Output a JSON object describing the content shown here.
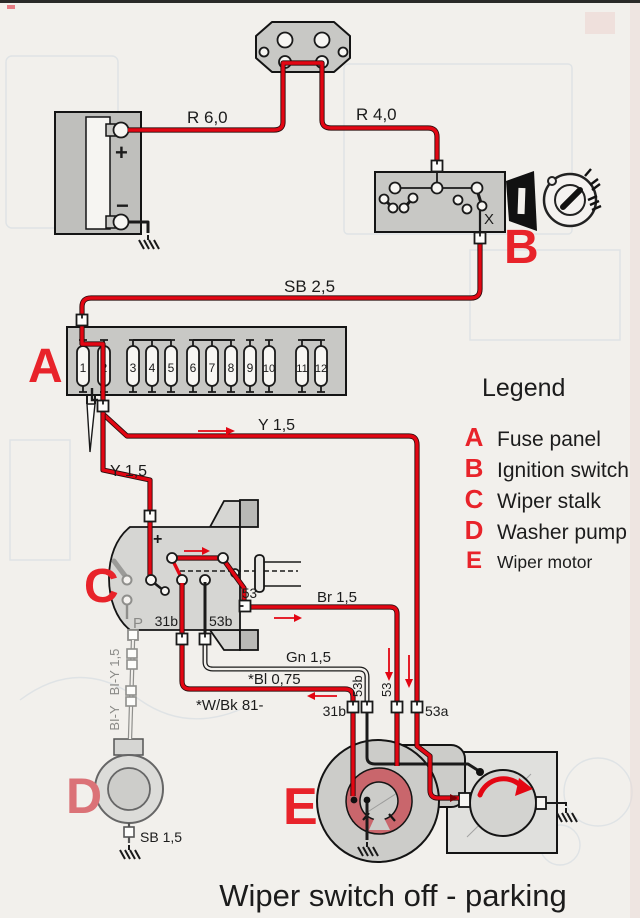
{
  "title": "Wiper switch off - parking",
  "legend": {
    "title": "Legend",
    "items": [
      {
        "key": "A",
        "label": "Fuse panel"
      },
      {
        "key": "B",
        "label": "Ignition switch"
      },
      {
        "key": "C",
        "label": "Wiper stalk"
      },
      {
        "key": "D",
        "label": "Washer pump"
      },
      {
        "key": "E",
        "label": "Wiper motor"
      }
    ]
  },
  "wires": {
    "r60": "R 6,0",
    "r40": "R 4,0",
    "sb25": "SB 2,5",
    "y15_to_53a": "Y 1,5",
    "y15_to_stalk": "Y 1,5",
    "br15": "Br 1,5",
    "gn15": "Gn 1,5",
    "bl075": "*Bl 0,75",
    "wbk81": "*W/Bk 81-",
    "bly15": "BI-Y 1,5",
    "bly": "BI-Y",
    "sb15": "SB 1,5"
  },
  "components": {
    "battery": {
      "plus": "+",
      "minus": "−"
    },
    "fuse_panel": {
      "marker": "A",
      "fuses": [
        "1",
        "2",
        "3",
        "4",
        "5",
        "6",
        "7",
        "8",
        "9",
        "10",
        "11",
        "12"
      ]
    },
    "ignition_switch": {
      "marker": "B",
      "terminal_x": "X"
    },
    "wiper_stalk": {
      "marker": "C",
      "plus": "+",
      "p": "P",
      "t31b": "31b",
      "t53b": "53b",
      "t53": "53"
    },
    "washer_pump": {
      "marker": "D"
    },
    "wiper_motor": {
      "marker": "E",
      "t31b": "31b",
      "t53b": "53b",
      "t53": "53",
      "t53a": "53a"
    }
  },
  "colors": {
    "paper": "#f2f0ec",
    "wire_red": "#e30613",
    "wire_black": "#1a1a1a",
    "wire_gray": "#8f8f8c",
    "component_gray": "#c8c8c5",
    "park_ring_red": "#c9666c",
    "marker_red": "#e8232a",
    "marker_pink": "#db7277"
  }
}
